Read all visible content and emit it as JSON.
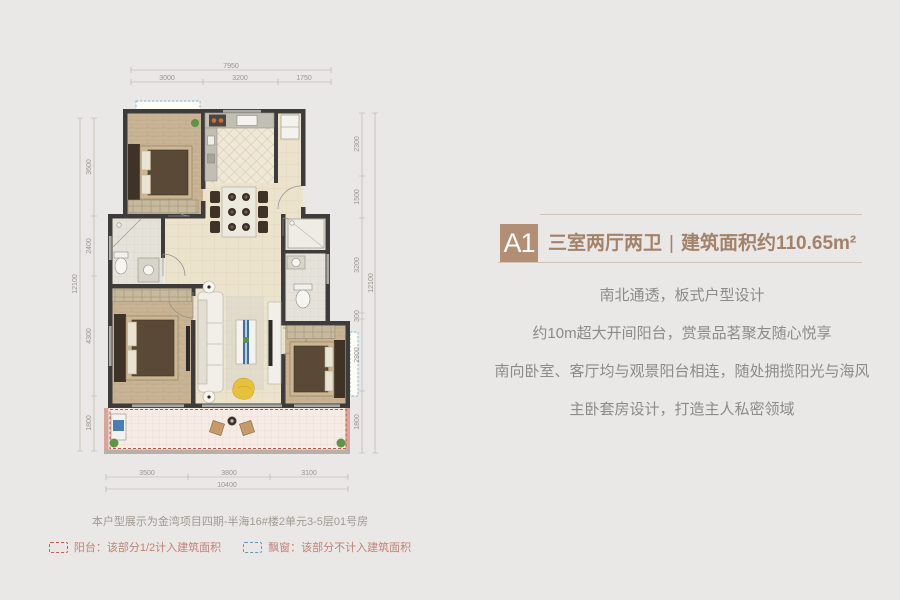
{
  "unit_card": {
    "badge": "A1",
    "badge_color": "#b18e74",
    "layout": "三室两厅两卫",
    "divider": "|",
    "area": "建筑面积约110.65m²",
    "title_color": "#a3826a"
  },
  "features": {
    "lines": [
      "南北通透，板式户型设计",
      "约10m超大开间阳台，赏景品茗聚友随心悦享",
      "南向卧室、客厅均与观景阳台相连，随处拥揽阳光与海风",
      "主卧套房设计，打造主人私密领域"
    ],
    "text_color": "#8b8b8b"
  },
  "plan": {
    "caption": "本户型展示为金湾项目四期-半海16#楼2单元3-5层01号房",
    "legend": [
      {
        "name": "balcony",
        "label": "阳台：该部分1/2计入建筑面积",
        "swatch_color": "#c25b54"
      },
      {
        "name": "bay-window",
        "label": "飘窗：该部分不计入建筑面积",
        "swatch_color": "#5d9bb5"
      }
    ],
    "dimensions": {
      "top_total": "7950",
      "top": [
        "3000",
        "3200",
        "1750"
      ],
      "bottom": [
        "3500",
        "3800",
        "3100"
      ],
      "bottom_total": "10400",
      "left": [
        "3600",
        "2400",
        "4300",
        "1800"
      ],
      "left_total": "12100",
      "right": [
        "2300",
        "1500",
        "3200",
        "300",
        "2800",
        "1800"
      ],
      "right_total": "12100"
    },
    "colors": {
      "wall": "#3d3c3a",
      "wood_floor": "#c8b394",
      "tile_floor": "#ece3cd",
      "balcony_dash": "#c0544e",
      "bay_dash": "#7fb0c4",
      "accent_yellow": "#e6c23c"
    }
  }
}
